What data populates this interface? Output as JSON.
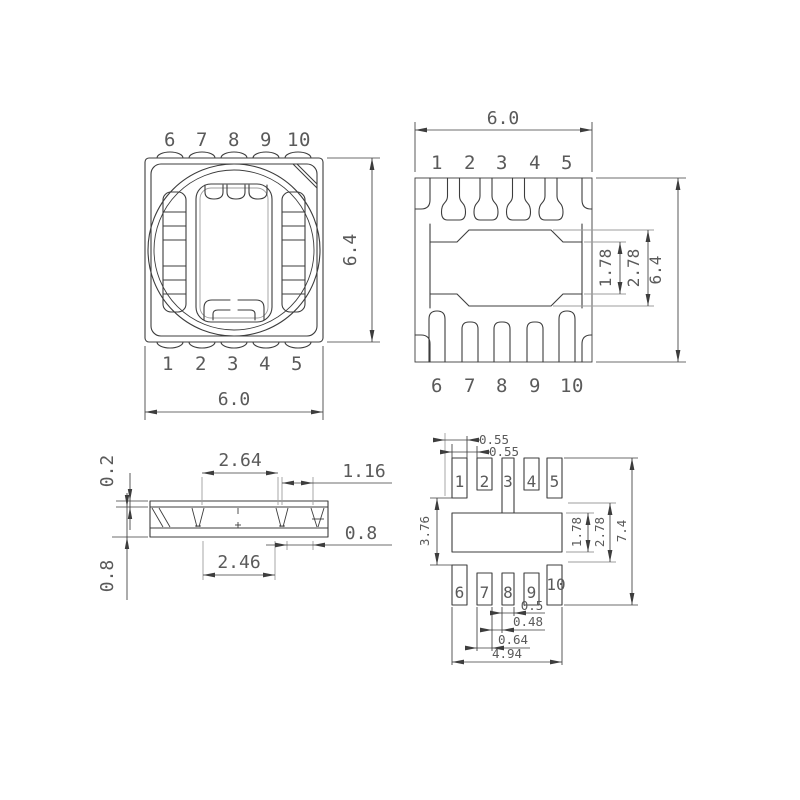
{
  "colors": {
    "line": "#3d3d3d",
    "gray": "#9e9e9e",
    "text": "#5a5a5a"
  },
  "views": {
    "top_view": {
      "pins_top": [
        "6",
        "7",
        "8",
        "9",
        "10"
      ],
      "pins_bottom": [
        "1",
        "2",
        "3",
        "4",
        "5"
      ],
      "dims": {
        "width": "6.0",
        "height": "6.4"
      }
    },
    "bottom_view": {
      "pins_top": [
        "1",
        "2",
        "3",
        "4",
        "5"
      ],
      "pins_bottom": [
        "6",
        "7",
        "8",
        "9",
        "10"
      ],
      "dims": {
        "width": "6.0",
        "height": "6.4",
        "center_height": "1.78",
        "center_outer_height": "2.78"
      }
    },
    "side_view": {
      "dims": {
        "top_layer": "0.2",
        "body_height": "0.8",
        "top_span": "2.64",
        "lead_offset": "1.16",
        "bottom_span": "2.46",
        "lead_gap": "0.8"
      }
    },
    "pad_layout": {
      "pads_top": [
        "1",
        "2",
        "3",
        "4",
        "5"
      ],
      "pads_bottom": [
        "6",
        "7",
        "8",
        "9",
        "10"
      ],
      "dims": {
        "offset_a": "0.55",
        "offset_b": "0.55",
        "row_gap": "3.76",
        "center_height": "1.78",
        "center_outer_height": "2.78",
        "overall_height": "7.4",
        "pad8_width": "0.5",
        "pad_gap": "0.48",
        "pad7_width": "0.64",
        "overall_width": "4.94"
      }
    }
  }
}
